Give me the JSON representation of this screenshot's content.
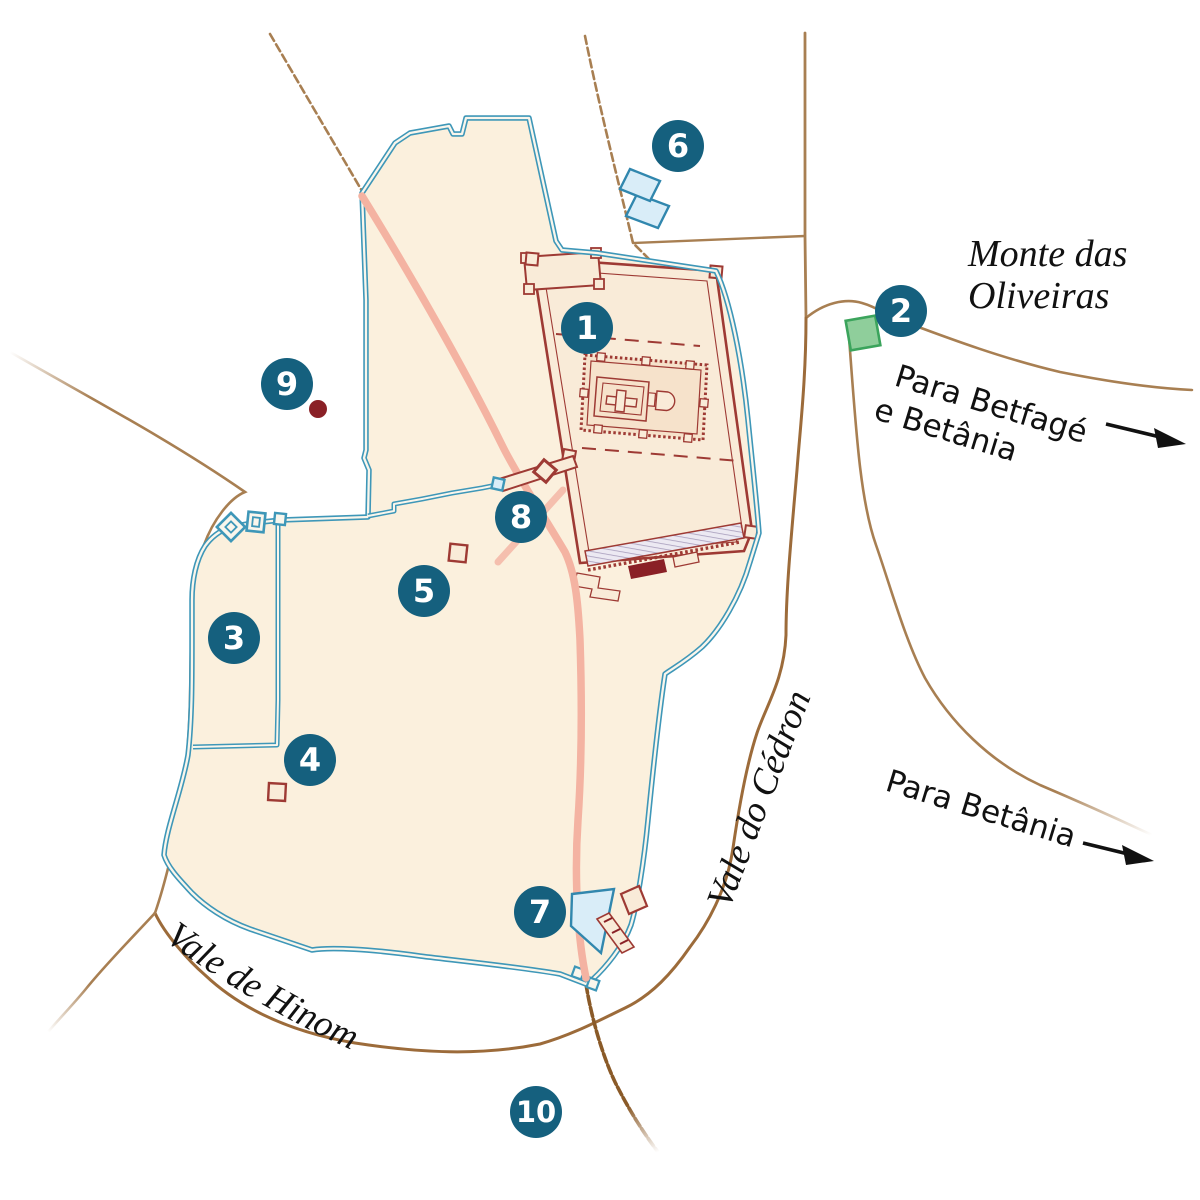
{
  "map_labels": {
    "monte_line1": "Monte das",
    "monte_line2": "Oliveiras",
    "betfage_line1": "Para Betfagé",
    "betfage_line2": "e Betânia",
    "betania": "Para Betânia",
    "cedron": "Vale do Cédron",
    "hinom": "Vale de Hinom"
  },
  "markers": [
    "1",
    "2",
    "3",
    "4",
    "5",
    "6",
    "7",
    "8",
    "9",
    "10"
  ],
  "icons": {
    "marker_badge": "numbered-circle-marker",
    "twin_pools": "pool",
    "siloam_pool": "pool",
    "green_plot": "garden-plot",
    "dark_dot": "site-dot",
    "route_arrow": "direction-arrow"
  },
  "colors": {
    "badge": "#15607E",
    "wall": "#3E97B8",
    "wall_gap": "#FAF6EC",
    "city_fill": "#FBF0DD",
    "platform_fill": "#F9EBD8",
    "court_fill": "#F6E2CB",
    "temple_line": "#9E3A34",
    "road": "#A87F52",
    "road_dark": "#8A5A28",
    "route_pink": "#F4B3A2",
    "pool_fill": "#D9EDF8",
    "pool_stroke": "#3187AE",
    "green_fill": "#8FCE9B",
    "green_stroke": "#3BA45C",
    "dark_dot": "#8A2026",
    "label_text": "#111111"
  }
}
